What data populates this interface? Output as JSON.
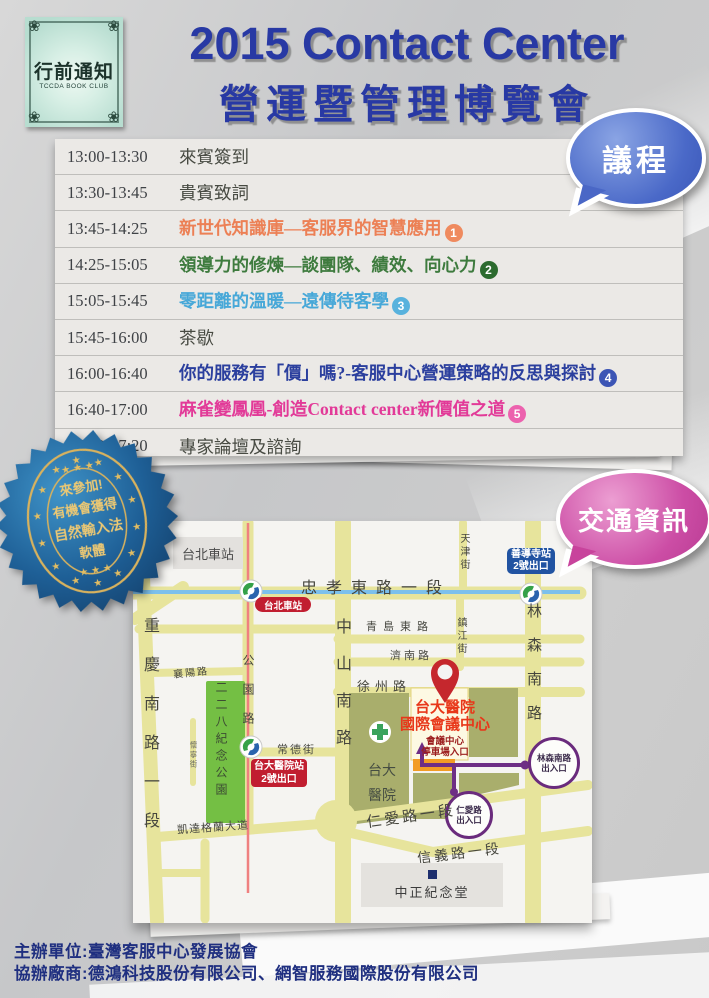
{
  "logo": {
    "title": "行前通知",
    "subtitle": "TCCDA BOOK CLUB"
  },
  "header": {
    "title_line1": "2015 Contact Center",
    "title_line2": "營運暨管理博覽會",
    "title_color": "#2839a4"
  },
  "agenda_badge": {
    "label": "議程",
    "color": "#4a67c6"
  },
  "traffic_badge": {
    "label": "交通資訊",
    "color": "#c8439c"
  },
  "schedule": {
    "rows": [
      {
        "time": "13:00-13:30",
        "title": "來賓簽到",
        "color": "#474a42"
      },
      {
        "time": "13:30-13:45",
        "title": "貴賓致詞",
        "color": "#474a42"
      },
      {
        "time": "13:45-14:25",
        "title": "新世代知識庫—客服界的智慧應用",
        "num": "1",
        "color": "#ec8055",
        "badge_color": "#ef8a5e"
      },
      {
        "time": "14:25-15:05",
        "title": "領導力的修煉—談團隊、績效、向心力",
        "num": "2",
        "color": "#3e7b3e",
        "badge_color": "#2c6b2f"
      },
      {
        "time": "15:05-15:45",
        "title": "零距離的溫暖—遠傳待客學",
        "num": "3",
        "color": "#47a8d8",
        "badge_color": "#58b2dd"
      },
      {
        "time": "15:45-16:00",
        "title": "茶歇",
        "color": "#474a42"
      },
      {
        "time": "16:00-16:40",
        "title": "你的服務有「價」嗎?-客服中心營運策略的反思與探討",
        "num": "4",
        "color": "#2b3f9e",
        "badge_color": "#3c55b5"
      },
      {
        "time": "16:40-17:00",
        "title": "麻雀變鳳凰-創造Contact center新價值之道",
        "num": "5",
        "color": "#e23a98",
        "badge_color": "#ec62ae"
      },
      {
        "time": "17:00-17:20",
        "title": "專家論壇及諮詢",
        "color": "#474a42"
      }
    ]
  },
  "prize_badge": {
    "lines": [
      "來參加!",
      "有機會獲得",
      "自然輸入法",
      "軟體"
    ]
  },
  "map": {
    "station_area": "台北車站",
    "metro_station_pill": "台北車站",
    "shandao": {
      "line1": "善導寺站",
      "line2": "2號出口"
    },
    "roads": {
      "zhongxiao": "忠孝東路一段",
      "tianjin": "天津街",
      "qingdao": "青島東路",
      "zhenjiang": "鎮江街",
      "jinan": "濟南路",
      "xuzhou": "徐州路",
      "xiangyang": "襄陽路",
      "chongqing": "重慶南路一段",
      "gongyuan": "公園路",
      "huaining": "懷寧街",
      "changde": "常德街",
      "zhongshan": "中山南路",
      "linsen": "林森南路",
      "renai": "仁愛路一段",
      "xinyi": "信義路一段",
      "ketagalan": "凱達格蘭大道"
    },
    "park": "二二八紀念公園",
    "ntuh_station": {
      "line1": "台大醫院站",
      "line2": "2號出口"
    },
    "ntuh": {
      "line1": "台大",
      "line2": "醫院"
    },
    "icc": {
      "line1": "台大醫院",
      "line2": "國際會議中心"
    },
    "parking": {
      "line1": "會議中心",
      "line2": "停車場入口"
    },
    "linsen_exit": {
      "line1": "林森南路",
      "line2": "出入口"
    },
    "renai_exit": {
      "line1": "仁愛路",
      "line2": "出入口"
    },
    "cks": "中正紀念堂"
  },
  "footer": {
    "line1": "主辦單位:臺灣客服中心發展協會",
    "line2": "協辦廠商:德鴻科技股份有限公司、網智服務國際股份有限公司"
  }
}
